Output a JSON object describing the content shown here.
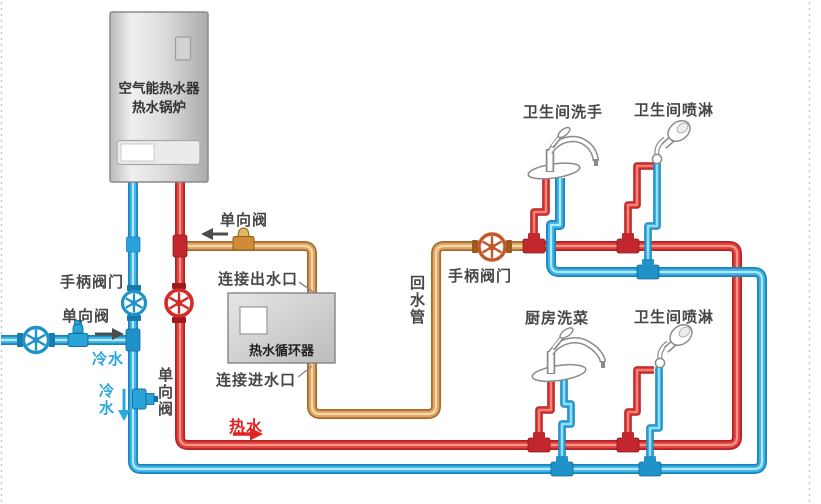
{
  "colors": {
    "hot_water": "#e2423a",
    "cold_water": "#3db2e6",
    "return_water": "#dfa363"
  },
  "boiler": {
    "name_line1": "空气能热水器",
    "name_line2": "热水锅炉"
  },
  "circulator": {
    "name": "热水循环器",
    "outlet_label": "连接出水口",
    "inlet_label": "连接进水口"
  },
  "valve_labels": {
    "check_top": "单向阀",
    "handle_left": "手柄阀门",
    "check_left": "单向阀",
    "check_bottom": "单向阀",
    "handle_right": "手柄阀门"
  },
  "flow_labels": {
    "cold_inlet": "冷水",
    "cold_down": "冷水",
    "hot": "热水",
    "return_pipe": "回水管"
  },
  "fixtures": [
    {
      "label": "卫生间洗手",
      "type": "faucet"
    },
    {
      "label": "卫生间喷淋",
      "type": "shower"
    },
    {
      "label": "厨房洗菜",
      "type": "faucet"
    },
    {
      "label": "卫生间喷淋",
      "type": "shower"
    }
  ]
}
